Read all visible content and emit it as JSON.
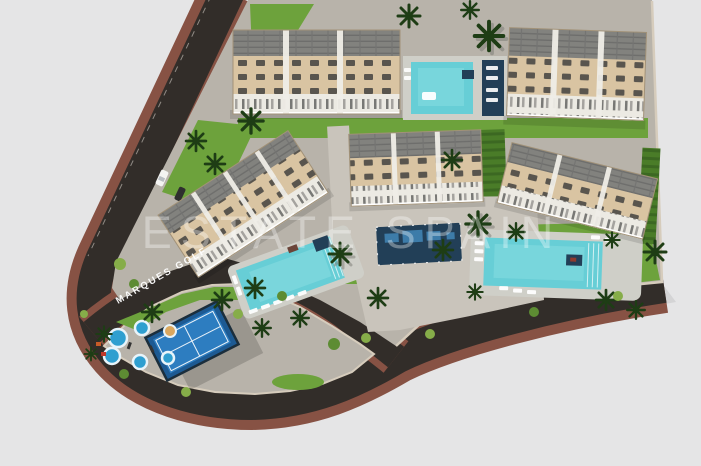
{
  "scene": {
    "type": "aerial-3d-render",
    "description": "Top-down 3D architectural render of a residential complex masterplan with five apartment blocks, four swimming pools, a paddle tennis court and a kids splash playground, bounded by dark curving roads with brown sidewalks on a light grey background",
    "watermark": "ESTATE SPAIN"
  },
  "colors": {
    "background": "#e5e5e6",
    "bg_shadow": "#cfcfd1",
    "road": "#322d29",
    "sidewalk": "#875244",
    "ground": "#b8b3aa",
    "plaza": "#c9c4bb",
    "wall": "#d6ccbc",
    "grass": "#6da23c",
    "grass_dark": "#4a7c28",
    "hedge": "#3c6822",
    "palm": "#1e3d15",
    "palm_shadow": "#7a7a74",
    "roof": "#82827e",
    "facade": "#d9c4a2",
    "balcony": "#eceae3",
    "window": "#3a3a3a",
    "pool_water": "#67ced6",
    "pool_deck": "#cfcfc8",
    "navy_deck": "#223f57",
    "court_blue": "#2d7dc0",
    "court_surround": "#1d5a93",
    "court_fence": "#1b2e3c",
    "splash_blue": "#2f9fd0",
    "label_text": "#ffffff",
    "watermark_text": "#ffffff"
  },
  "site": {
    "buildings": [
      {
        "id": "block-top-left"
      },
      {
        "id": "block-top-right"
      },
      {
        "id": "block-mid-left"
      },
      {
        "id": "block-mid-center"
      },
      {
        "id": "block-mid-right"
      }
    ],
    "pools": [
      {
        "id": "pool-top"
      },
      {
        "id": "pool-main"
      },
      {
        "id": "pool-right"
      },
      {
        "id": "pool-feature-dark"
      }
    ],
    "amenities": [
      {
        "id": "paddle-tennis-court"
      },
      {
        "id": "kids-splash-playground"
      },
      {
        "id": "palm-trees"
      }
    ],
    "roads": [
      {
        "id": "perimeter-road",
        "label": ""
      },
      {
        "id": "access-road",
        "label": "MARQUES GOLF"
      }
    ]
  }
}
